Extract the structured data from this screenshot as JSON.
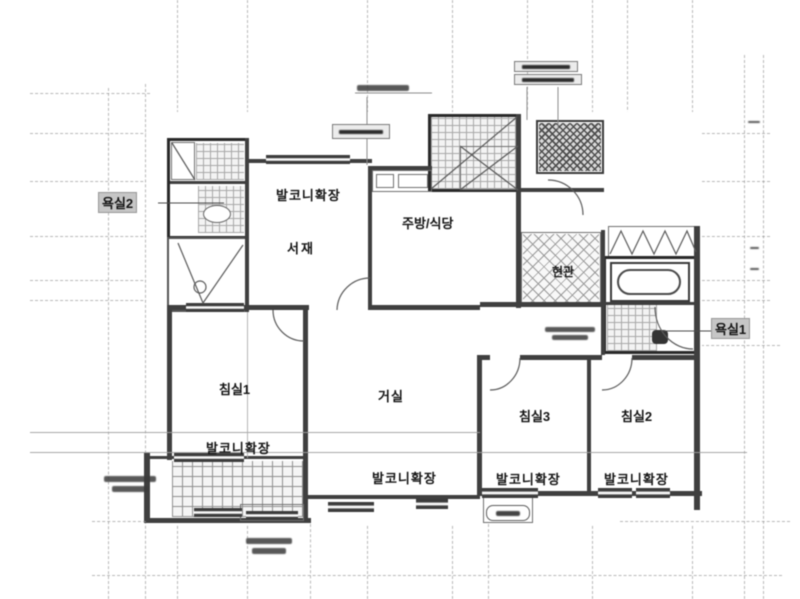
{
  "figure": {
    "labels": {
      "bath2": "욕실2",
      "balcony_study": "발코니확장",
      "study": "서재",
      "kitchen": "주방/식당",
      "entrance": "현관",
      "bath1": "욕실1",
      "bed1": "침실1",
      "living": "거실",
      "bed3": "침실3",
      "bed2": "침실2",
      "balcony_bed1": "발코니확장",
      "balcony_living": "발코니확장",
      "balcony_bed3": "발코니확장",
      "balcony_bed2": "발코니확장"
    },
    "colors": {
      "wall": "#3f3f3f",
      "gridline": "#9a9a9a",
      "label_text": "#141414",
      "label_highlight_bg": "#c6c6c6",
      "background": "#ffffff"
    }
  }
}
